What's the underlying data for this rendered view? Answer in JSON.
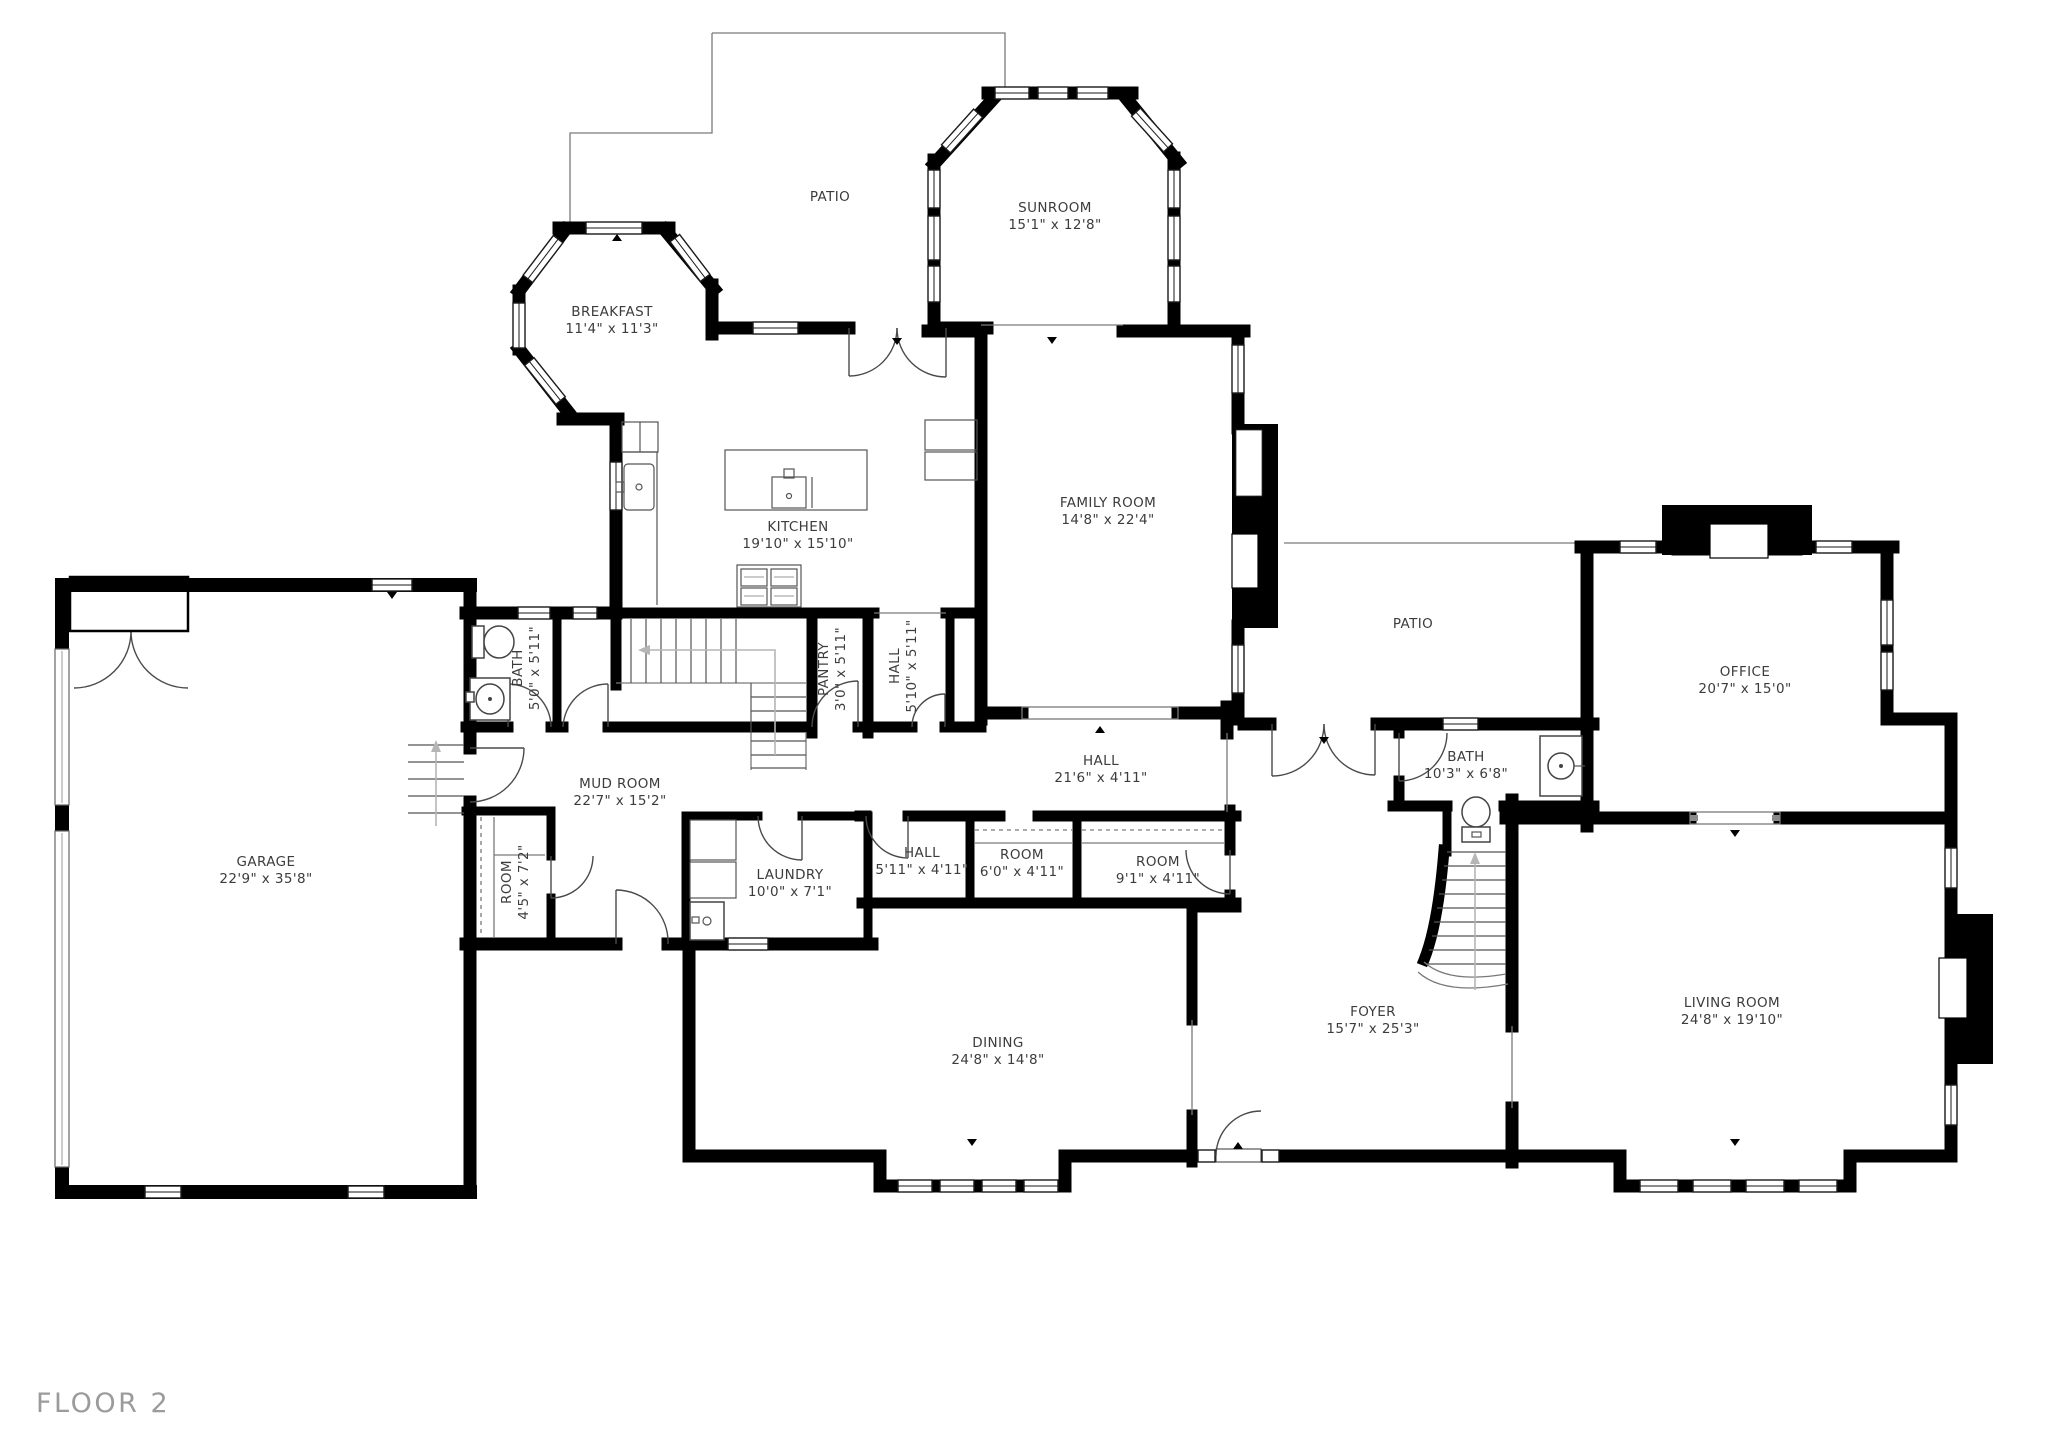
{
  "floor_label": "FLOOR 2",
  "colors": {
    "wall": "#000000",
    "thin_line": "#7a7a7a",
    "door_line": "#4a4a4a",
    "label_text": "#3c3c3c",
    "floor_label_text": "#9b9b9b",
    "guide_arrow": "#b5b5b5",
    "background": "#ffffff"
  },
  "rooms": [
    {
      "id": "patio-top",
      "name": "PATIO",
      "dims": ""
    },
    {
      "id": "sunroom",
      "name": "SUNROOM",
      "dims": "15'1\" x 12'8\""
    },
    {
      "id": "breakfast",
      "name": "BREAKFAST",
      "dims": "11'4\" x 11'3\""
    },
    {
      "id": "kitchen",
      "name": "KITCHEN",
      "dims": "19'10\" x 15'10\""
    },
    {
      "id": "family-room",
      "name": "FAMILY ROOM",
      "dims": "14'8\" x 22'4\""
    },
    {
      "id": "patio-right",
      "name": "PATIO",
      "dims": ""
    },
    {
      "id": "office",
      "name": "OFFICE",
      "dims": "20'7\" x 15'0\""
    },
    {
      "id": "bath-small",
      "name": "BATH",
      "dims": "5'0\" x 5'11\""
    },
    {
      "id": "pantry",
      "name": "PANTRY",
      "dims": "3'0\" x 5'11\""
    },
    {
      "id": "hall-small",
      "name": "HALL",
      "dims": "5'10\" x 5'11\""
    },
    {
      "id": "hall-main",
      "name": "HALL",
      "dims": "21'6\" x 4'11\""
    },
    {
      "id": "bath-right",
      "name": "BATH",
      "dims": "10'3\" x 6'8\""
    },
    {
      "id": "mud-room",
      "name": "MUD ROOM",
      "dims": "22'7\" x 15'2\""
    },
    {
      "id": "garage",
      "name": "GARAGE",
      "dims": "22'9\" x 35'8\""
    },
    {
      "id": "room-small",
      "name": "ROOM",
      "dims": "4'5\" x 7'2\""
    },
    {
      "id": "laundry",
      "name": "LAUNDRY",
      "dims": "10'0\" x 7'1\""
    },
    {
      "id": "hall-closet",
      "name": "HALL",
      "dims": "5'11\" x 4'11\""
    },
    {
      "id": "room-6",
      "name": "ROOM",
      "dims": "6'0\" x 4'11\""
    },
    {
      "id": "room-9",
      "name": "ROOM",
      "dims": "9'1\" x 4'11\""
    },
    {
      "id": "dining",
      "name": "DINING",
      "dims": "24'8\" x 14'8\""
    },
    {
      "id": "foyer",
      "name": "FOYER",
      "dims": "15'7\" x 25'3\""
    },
    {
      "id": "living-room",
      "name": "LIVING ROOM",
      "dims": "24'8\" x 19'10\""
    }
  ]
}
